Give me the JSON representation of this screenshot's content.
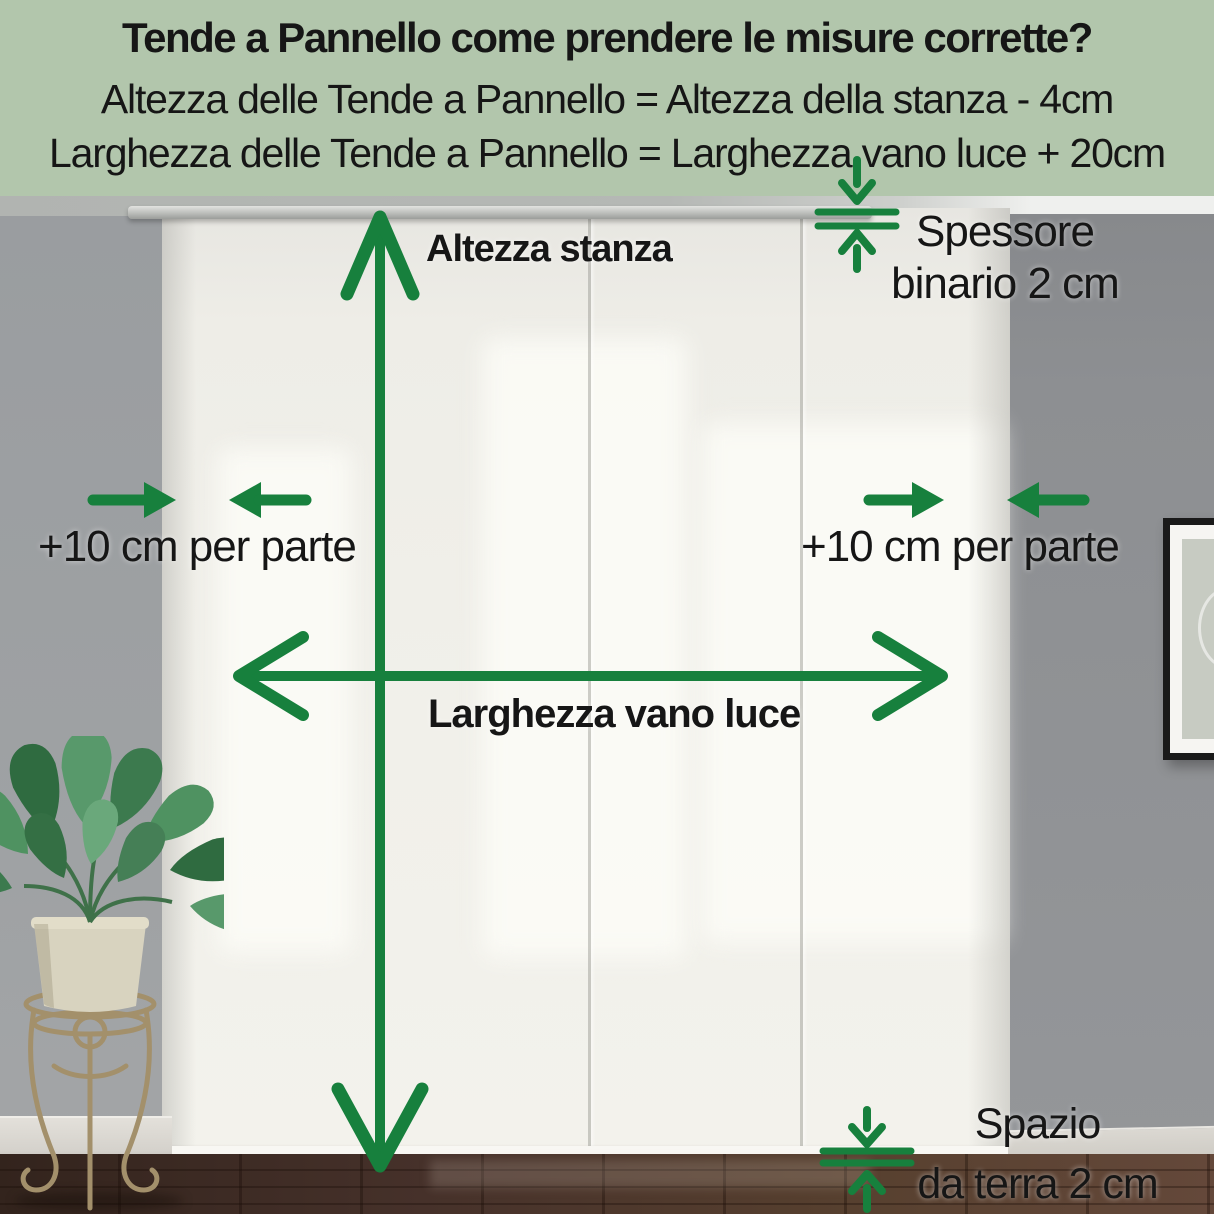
{
  "header": {
    "title": "Tende a Pannello come prendere le misure corrette?",
    "formula_height": "Altezza delle Tende a Pannello = Altezza della stanza - 4cm",
    "formula_width": "Larghezza delle Tende a Pannello = Larghezza vano luce + 20cm"
  },
  "labels": {
    "room_height": "Altezza stanza",
    "window_width": "Larghezza vano luce",
    "add_left": "+10 cm per parte",
    "add_right": "+10 cm per parte",
    "rail_line1": "Spessore",
    "rail_line2": "binario 2 cm",
    "floor_line1": "Spazio",
    "floor_line2": "da terra 2 cm"
  },
  "colors": {
    "accent_green": "#17803d",
    "header_bg": "#b2c6ac",
    "text_color": "#161616",
    "wall_left": "#9a9da0",
    "wall_right": "#8f9194",
    "curtain_white": "#f1f0ea",
    "floor_brown": "#46312a"
  }
}
